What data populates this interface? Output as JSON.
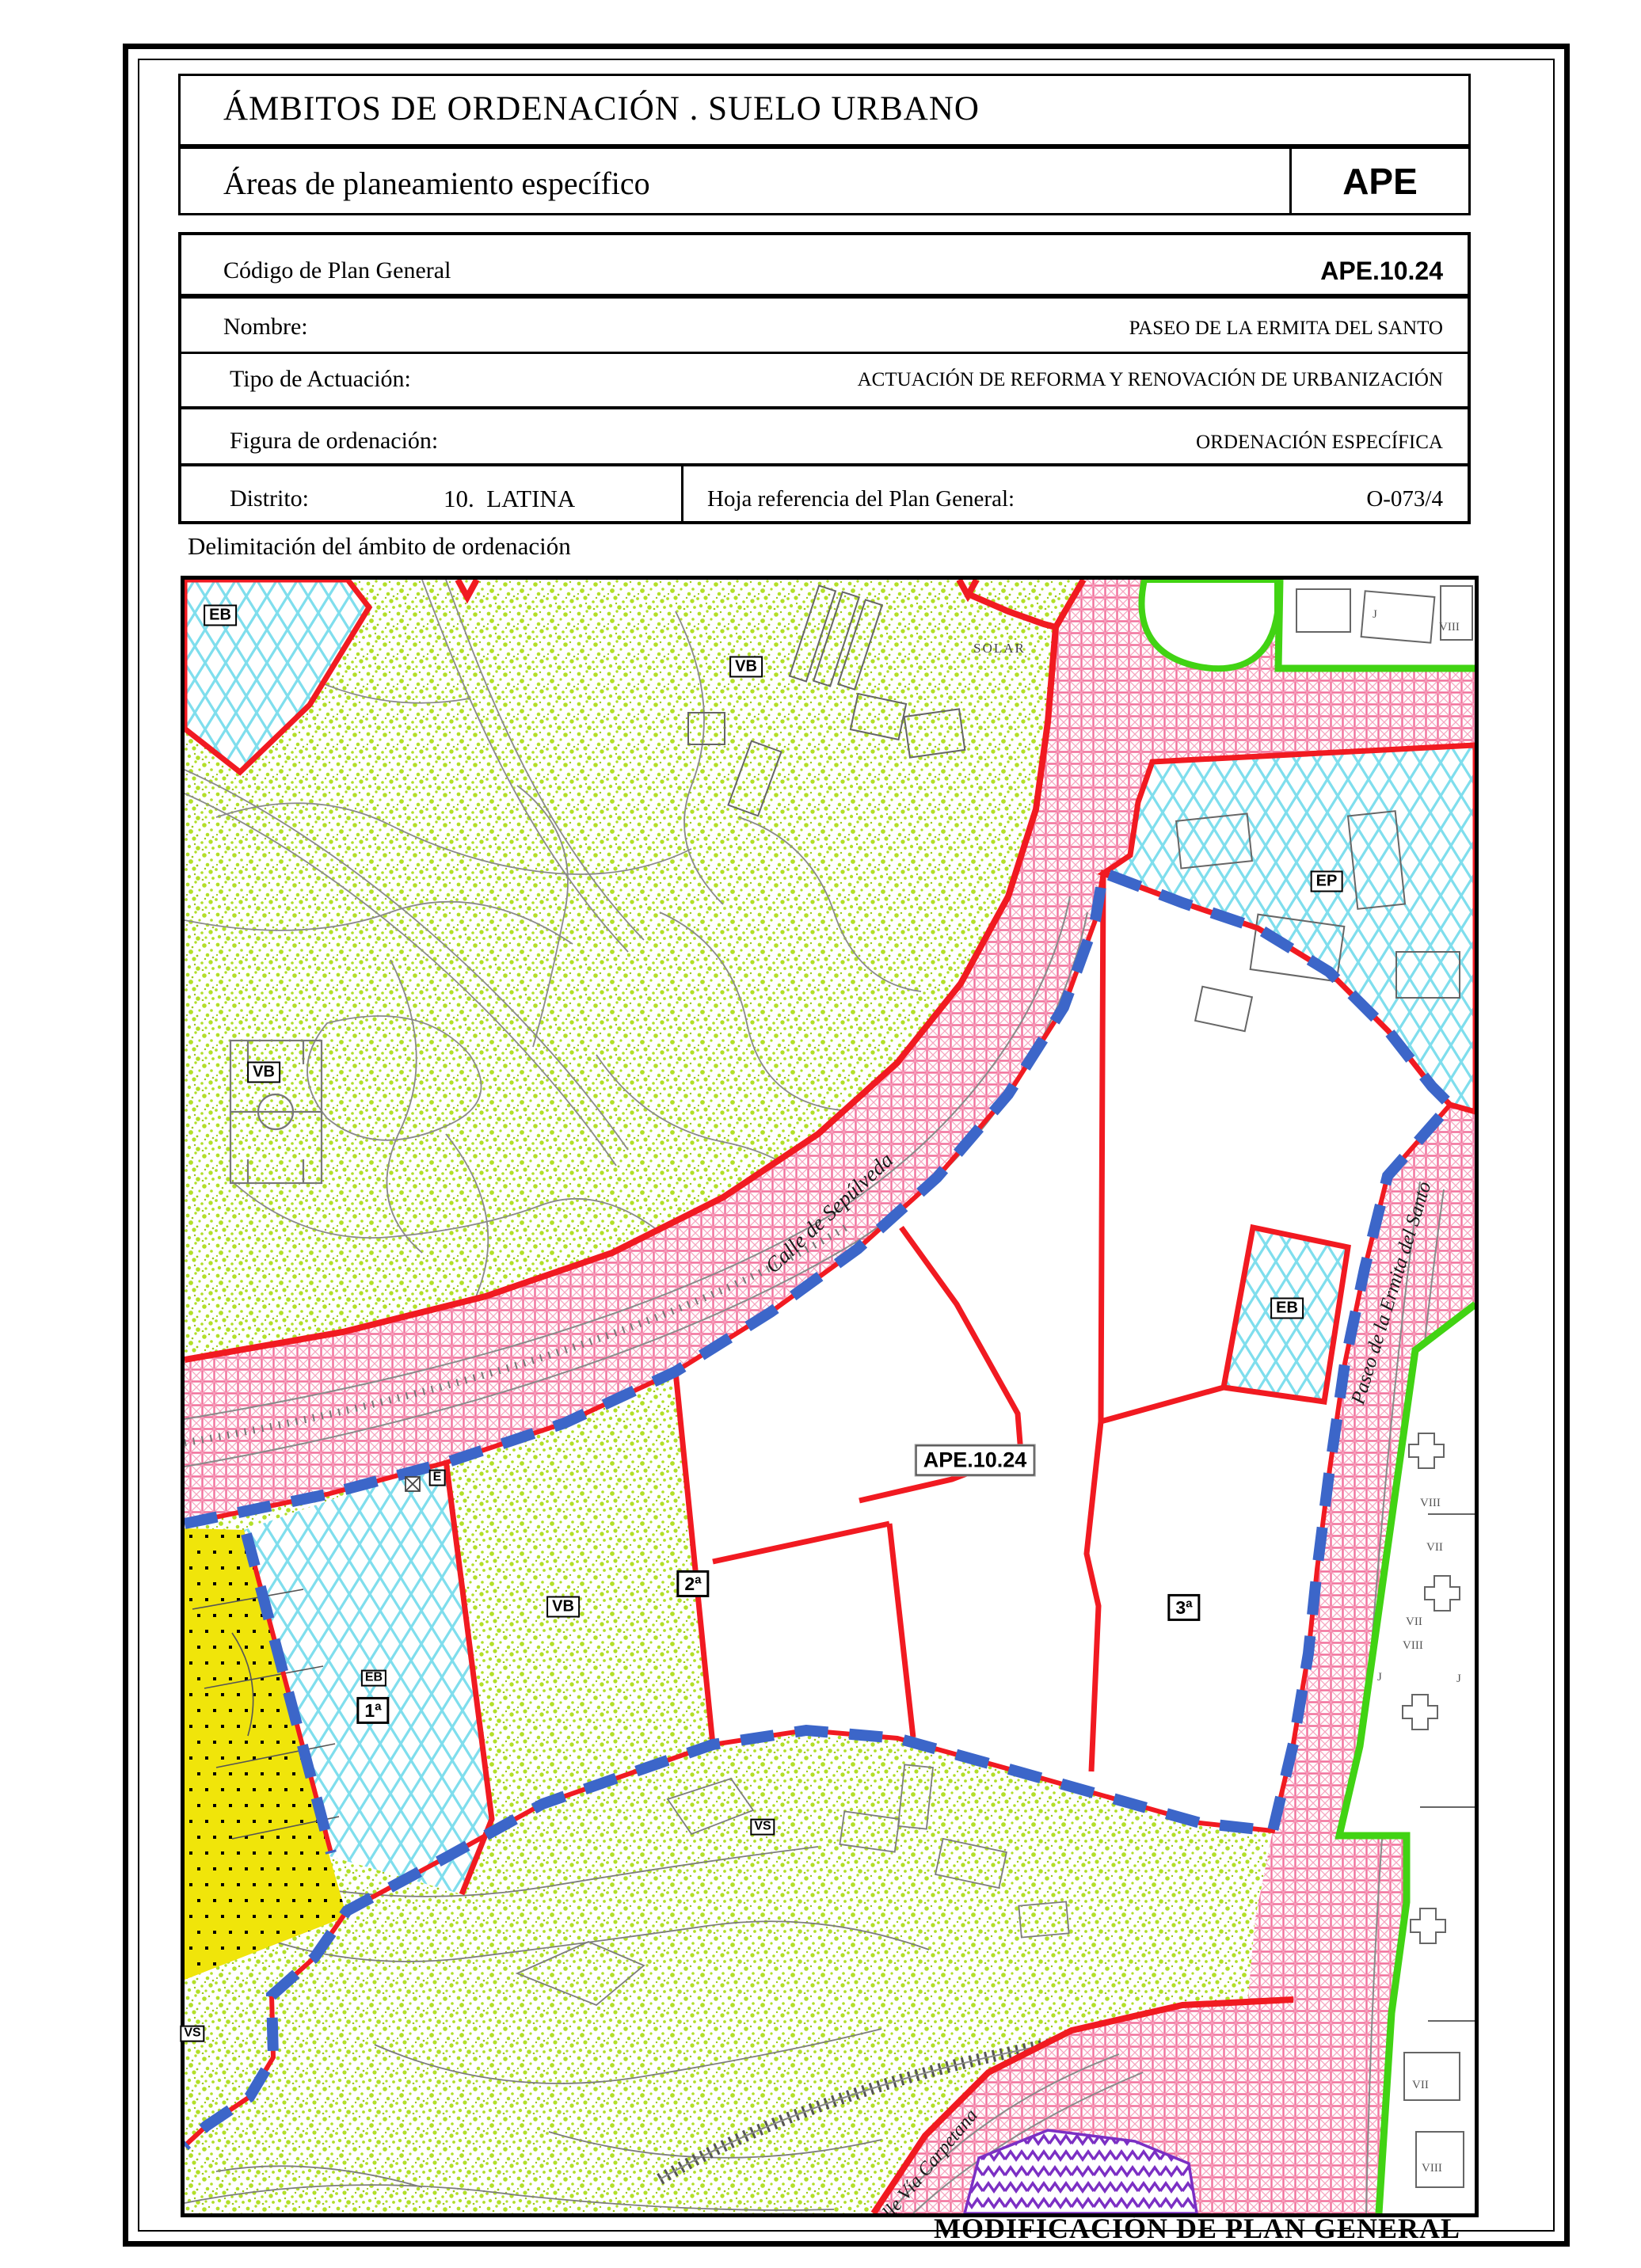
{
  "header": {
    "title": "ÁMBITOS DE ORDENACIÓN . SUELO URBANO",
    "subtitle": "Áreas de planeamiento específico",
    "badge": "APE"
  },
  "table": {
    "codigo_label": "Código de Plan General",
    "codigo_value": "APE.10.24",
    "nombre_label": "Nombre:",
    "nombre_value": "PASEO DE LA ERMITA DEL SANTO",
    "tipo_label": "Tipo de Actuación:",
    "tipo_value": "ACTUACIÓN DE REFORMA Y RENOVACIÓN DE URBANIZACIÓN",
    "figura_label": "Figura de ordenación:",
    "figura_value": "ORDENACIÓN ESPECÍFICA",
    "distrito_label": "Distrito:",
    "distrito_value": "10.  LATINA",
    "hoja_label": "Hoja referencia del Plan General:",
    "hoja_value": "O-073/4"
  },
  "caption": "Delimitación del ámbito de ordenación",
  "footer": "MODIFICACIÓN DE PLAN GENERAL",
  "map": {
    "ape_label": "APE.10.24",
    "solar_label": "SOLAR",
    "zone_labels": [
      {
        "text": "EB"
      },
      {
        "text": "VB"
      },
      {
        "text": "EP"
      },
      {
        "text": "VB"
      },
      {
        "text": "EB"
      },
      {
        "text": "E"
      },
      {
        "text": "EB"
      },
      {
        "text": "1ª"
      },
      {
        "text": "VB"
      },
      {
        "text": "2ª"
      },
      {
        "text": "VS"
      },
      {
        "text": "3ª"
      },
      {
        "text": "VS"
      }
    ],
    "streets": [
      {
        "name": "Calle de Sepúlveda"
      },
      {
        "name": "Paseo de la Ermita del Santo"
      },
      {
        "name": "Calle Vía Carpetana"
      }
    ],
    "building_labels": [
      "VIII",
      "VII",
      "VII",
      "VIII",
      "J",
      "J",
      "VIII",
      "J",
      "VII",
      "VIII"
    ]
  },
  "colors": {
    "boundary_red": "#f11a21",
    "road_pink": "#f2719c",
    "facility_cyan": "#7fdeed",
    "speckle_green": "#b2df28",
    "delimit_blue": "#3c66c9",
    "edge_green": "#41d313",
    "zone_yellow": "#f0e50a",
    "zone_purple": "#7b2fc4"
  }
}
